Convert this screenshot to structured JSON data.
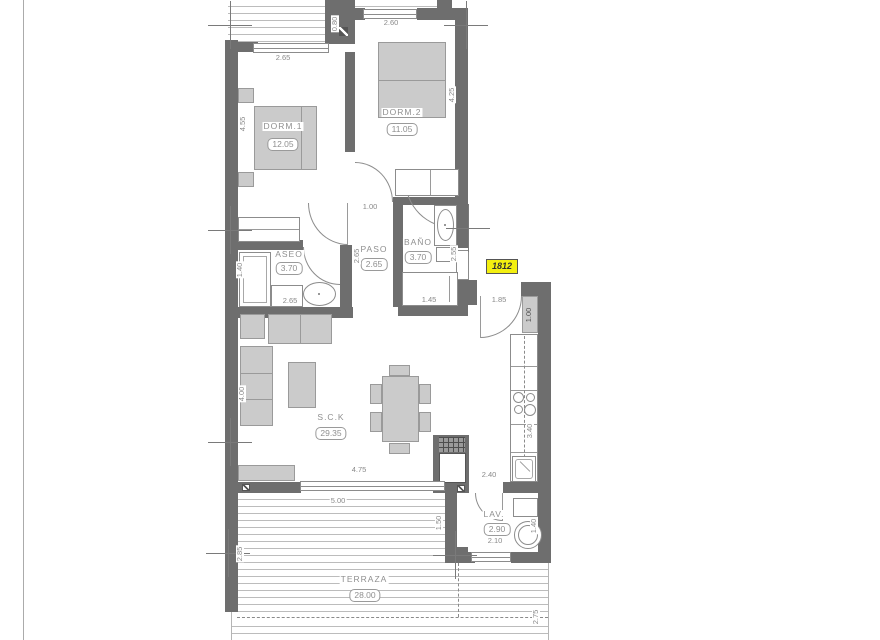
{
  "unit": {
    "number": "1812"
  },
  "rooms": {
    "dorm1": {
      "name": "DORM.1",
      "area": "12.05"
    },
    "dorm2": {
      "name": "DORM.2",
      "area": "11.05"
    },
    "aseo": {
      "name": "ASEO",
      "area": "3.70"
    },
    "paso": {
      "name": "PASO",
      "area": "2.65"
    },
    "bano": {
      "name": "BAÑO",
      "area": "3.70"
    },
    "sck": {
      "name": "S.C.K",
      "area": "29.35"
    },
    "lav": {
      "name": "LAV.",
      "area": "2.90"
    },
    "terraza": {
      "name": "TERRAZA",
      "area": "28.00"
    }
  },
  "dimensions": {
    "dorm1_window": "2.65",
    "dorm2_window": "2.60",
    "top_terrace_depth": "0.80",
    "dorm1_depth": "4.55",
    "dorm2_depth": "4.25",
    "hall_door": "1.00",
    "paso_depth": "2.65",
    "aseo_shower": "1.40",
    "aseo_width": "2.65",
    "bano_bath": "1.45",
    "bano_counter": "2.55",
    "entry_door": "1.85",
    "entry_closet": "1.00",
    "living_depth": "4.00",
    "kitchen_depth": "3.40",
    "kitchen_width": "2.40",
    "living_window": "4.75",
    "terrace_width": "5.00",
    "lav_depth": "1.50",
    "lav_width": "2.10",
    "lav_machine": "1.40",
    "terrace_left_depth": "2.85",
    "terrace_right_depth": "2.75"
  },
  "colors": {
    "wall": "#6e6e6e",
    "furniture": "#cbcbcb",
    "unit_highlight": "#f3ef10",
    "line_gray": "#8a8a8a"
  }
}
